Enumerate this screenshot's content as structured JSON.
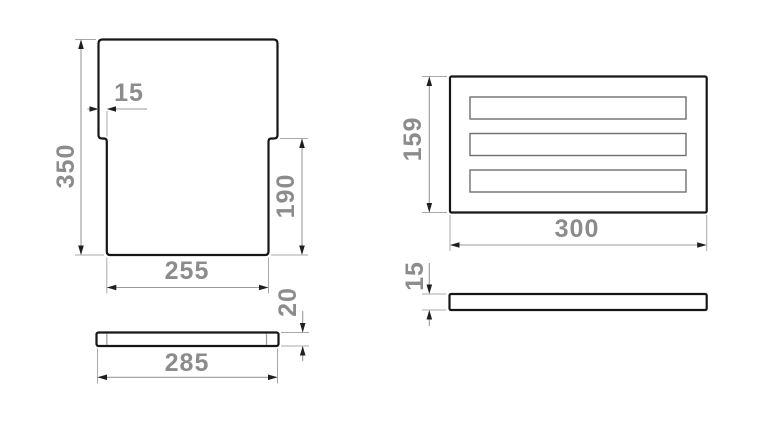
{
  "drawing": {
    "kind": "technical-dimension-drawing",
    "units_implied": "mm",
    "colors": {
      "background": "#ffffff",
      "part_outline": "#161616",
      "dimension_line": "#9a9a9a",
      "arrowhead": "#1f1f1f",
      "dimension_text": "#8c8c8c",
      "slot_outline": "#6e6e6e"
    },
    "board_top": {
      "height": "350",
      "notch": "15",
      "lower_height": "190",
      "bottom_width": "255"
    },
    "board_side": {
      "width": "285",
      "thickness": "20"
    },
    "rack_top": {
      "height": "159",
      "width": "300",
      "slot_count": 3
    },
    "rack_side": {
      "thickness": "15"
    }
  }
}
